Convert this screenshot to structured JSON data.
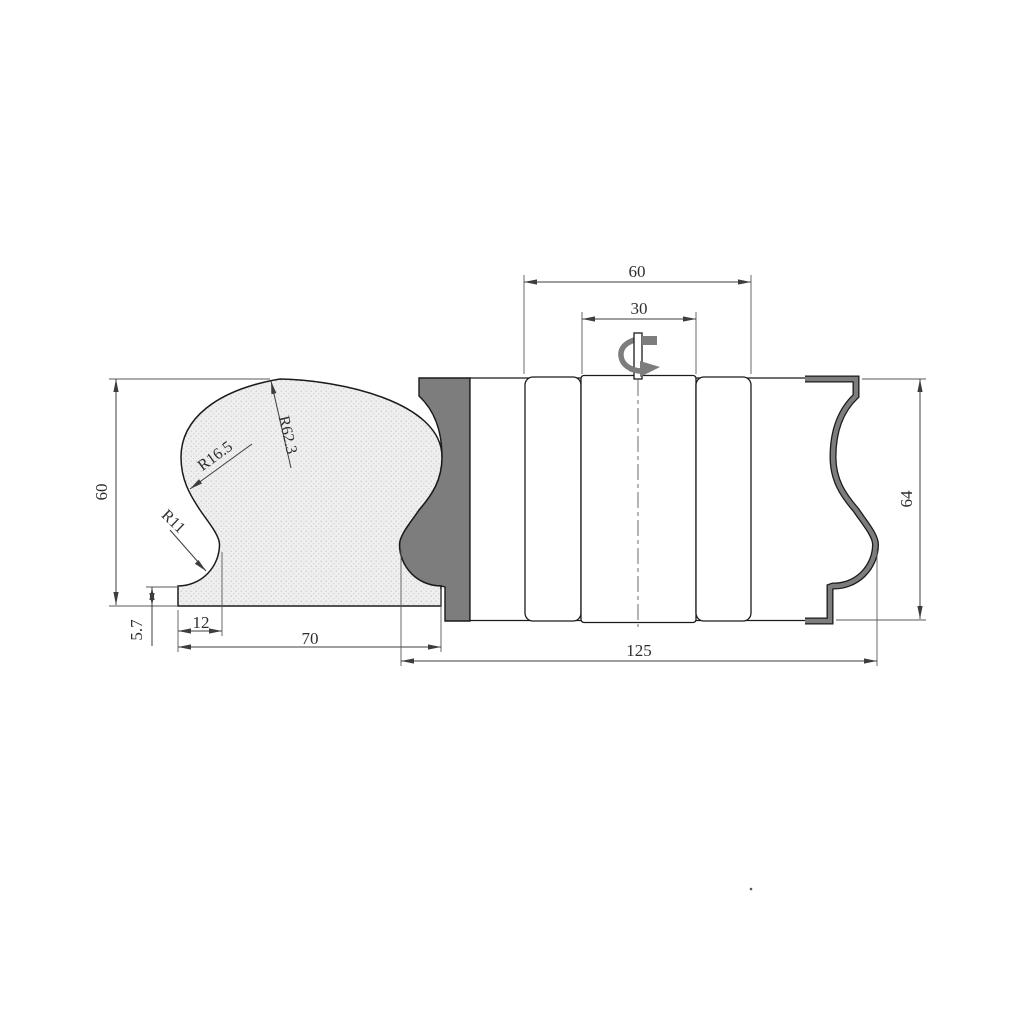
{
  "colors": {
    "outline": "#1b1b1b",
    "knife_gray": "#7d7d7d",
    "rail_fill": "#efefef",
    "rail_dots": "#c9c9c9",
    "dim_lines": "#3d3d3d",
    "background": "#ffffff"
  },
  "dims": {
    "rail_height": "60",
    "rail_base_height": "5.7",
    "rail_base_inset": "12",
    "rail_width": "70",
    "crown_radius": "R62.3",
    "shoulder_radius": "R16.5",
    "neck_radius": "R11",
    "body_section_width": "60",
    "hub_width": "30",
    "overall_width": "125",
    "knife_span": "64"
  }
}
